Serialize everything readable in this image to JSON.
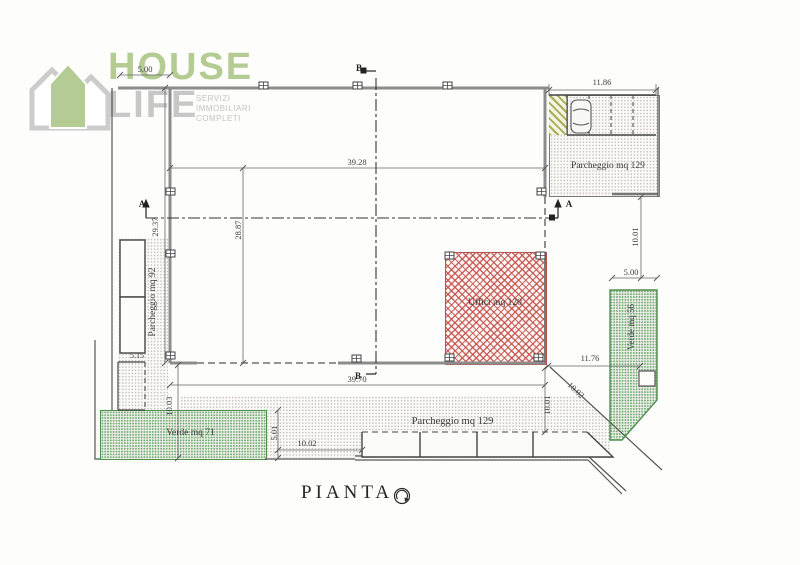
{
  "logo": {
    "house": "HOUSE",
    "life": "LIFE",
    "tagline": [
      "SERVIZI",
      "IMMOBILIARI",
      "COMPLETI"
    ],
    "colors": {
      "green": "#b4cc94",
      "gray": "#c7c7c7"
    }
  },
  "plan": {
    "title": "PIANTA",
    "labels": {
      "uffici": "Uffici mq 120",
      "parcheggio_left": "Parcheggio mq 92",
      "parcheggio_top": "Parcheggio mq 129",
      "parcheggio_bottom": "Parcheggio mq 129",
      "verde_left": "Verde mq 71",
      "verde_right": "Verde mq 56"
    },
    "dimensions": {
      "top_left_width": "5.00",
      "hall_width_top": "39.28",
      "hall_depth_inner": "28.87",
      "hall_depth_left": "29.37",
      "parking_top_width": "11.86",
      "right_upper_height": "10.01",
      "verde_right_width": "5.00",
      "bottom_right_width": "11.76",
      "diagonal_length": "10.02",
      "bottom_right_height": "10.01",
      "hall_width_bottom": "39.70",
      "verde_left_depth": "10.03",
      "verde_left_height": "5.01",
      "bottom_left_width": "10.02",
      "left_stall_width": "5.15"
    },
    "section_markers": {
      "a": "A",
      "b": "B"
    },
    "icons": {
      "north_indicator": "compass-circle",
      "car": "car-top-view",
      "logo_houses": "overlapping-houses"
    },
    "colors": {
      "hatch_red": "#c44d46",
      "verde_green": "#4e8f4e",
      "ramp_olive": "#98a23a",
      "line": "#4d4d4d"
    }
  }
}
